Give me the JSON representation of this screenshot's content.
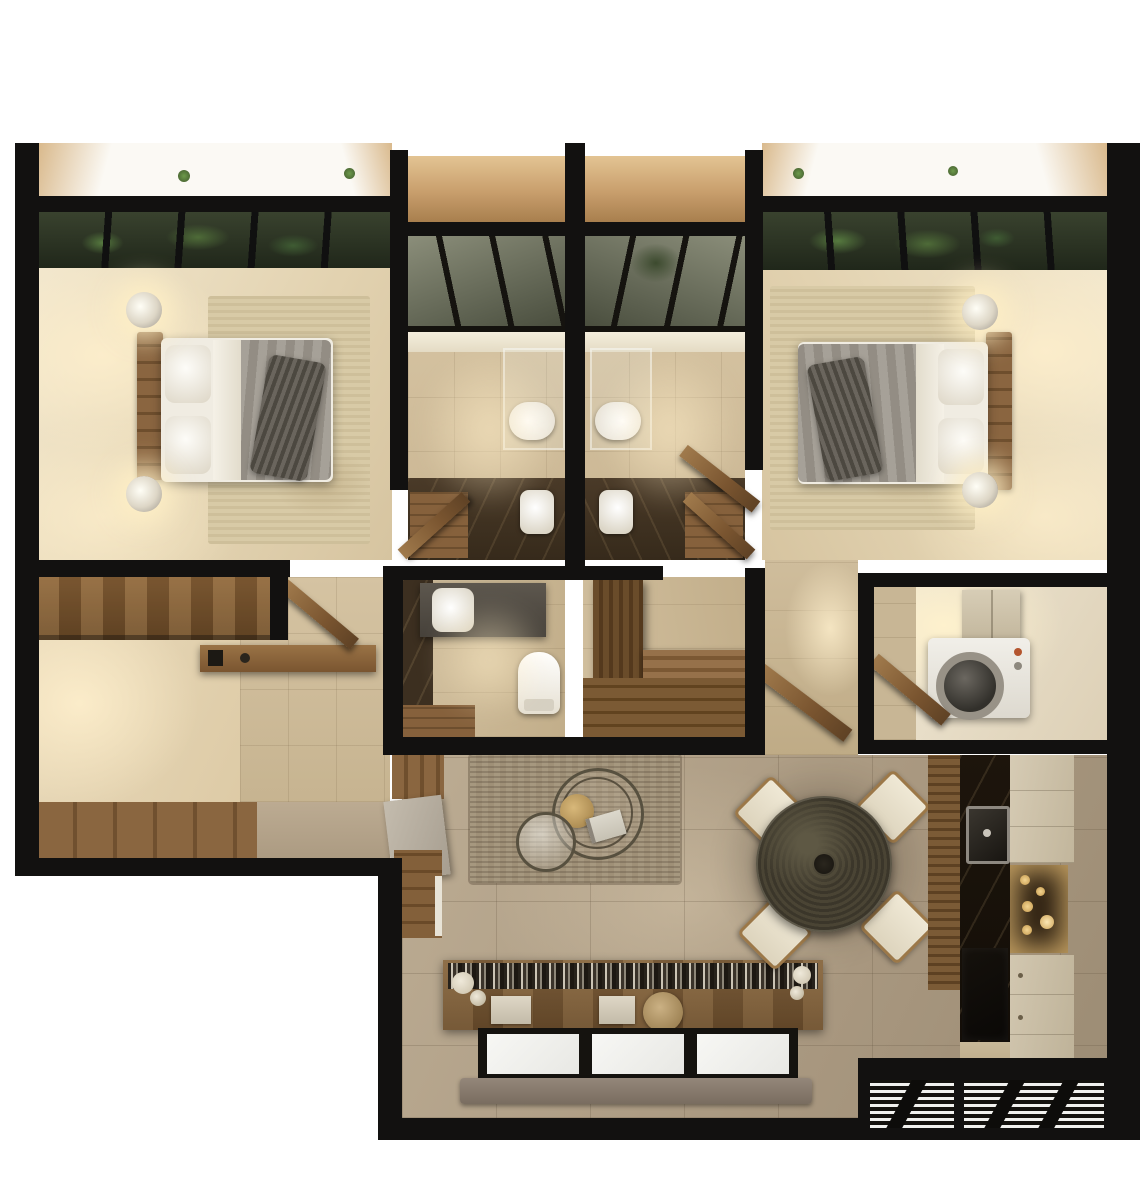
{
  "scene": {
    "type": "3d-floor-plan-render",
    "title": "Two-bedroom apartment — top-down 3D render",
    "rooms": [
      {
        "name": "bedroom-left",
        "furniture": [
          "double-bed",
          "headboard",
          "nightstand-2x",
          "lamp-2x",
          "area-rug",
          "wall-art",
          "garden-skylight"
        ]
      },
      {
        "name": "bathroom-left",
        "furniture": [
          "skylight",
          "shower-glass",
          "toilet",
          "basin",
          "wood-door"
        ]
      },
      {
        "name": "bathroom-right",
        "furniture": [
          "skylight",
          "shower-glass",
          "toilet",
          "basin",
          "wood-door"
        ]
      },
      {
        "name": "bedroom-right",
        "furniture": [
          "double-bed",
          "headboard",
          "nightstand-2x",
          "lamp-2x",
          "area-rug",
          "wall-art",
          "garden-skylight"
        ]
      },
      {
        "name": "study",
        "furniture": [
          "wood-desk",
          "wall-shelf",
          "sofa",
          "wood-floor"
        ]
      },
      {
        "name": "powder-room",
        "furniture": [
          "basin",
          "counter",
          "toilet"
        ]
      },
      {
        "name": "walk-in-closet",
        "furniture": [
          "wardrobe",
          "bench-platform",
          "plank-floor"
        ]
      },
      {
        "name": "hallway",
        "furniture": [
          "open-wood-door"
        ]
      },
      {
        "name": "utility-room",
        "furniture": [
          "washing-machine",
          "wall-cabinet",
          "wood-door"
        ]
      },
      {
        "name": "living-room",
        "furniture": [
          "sofa",
          "nesting-coffee-tables",
          "brass-tray",
          "jute-rug",
          "book",
          "media-bookshelf-console",
          "window-triple",
          "balcony-sill",
          "sideboard"
        ]
      },
      {
        "name": "dining-area",
        "furniture": [
          "round-stone-table",
          "chair-4x",
          "floor-shadow"
        ]
      },
      {
        "name": "kitchen",
        "furniture": [
          "slat-wall",
          "dark-marble-counter",
          "sink",
          "cooktop",
          "upper-cabinet",
          "lit-shelf",
          "lower-cabinets"
        ]
      },
      {
        "name": "vents",
        "furniture": [
          "louvered-grille-2x"
        ]
      }
    ]
  },
  "colors": {
    "bg": "#ffffff",
    "wall": "#121110",
    "floor-cream": "#ecdfc3",
    "floor-tile": "#cdbb9b",
    "floor-taupe": "#b2a28a",
    "floor-wood": "#7c5a36",
    "rug-beige": "#d7caa7",
    "rug-jute": "#a2937a",
    "wood": "#7d5a36",
    "wood-dark": "#5f4527",
    "wood-door": "#8a6239",
    "marble-dark": "#3f3222",
    "kitchen-counter": "#171109",
    "cabinet-light": "#cfc4ad",
    "sofa": "#d8d0c0",
    "cushion": "#8f7347",
    "duvet": "#9c968c",
    "linen": "#f3efe5",
    "throw": "#5b564f",
    "glass-green": "#2a3322",
    "plant": "#4e6b38",
    "ledge-tan": "#c89e6c",
    "window-pane": "#f3f3f0",
    "sill": "#87796b",
    "table-dining": "#45402f",
    "chair-seat": "#e9e2cf",
    "brass": "#b9975c",
    "washer": "#ece9e3",
    "glow": "#ffeecb"
  }
}
